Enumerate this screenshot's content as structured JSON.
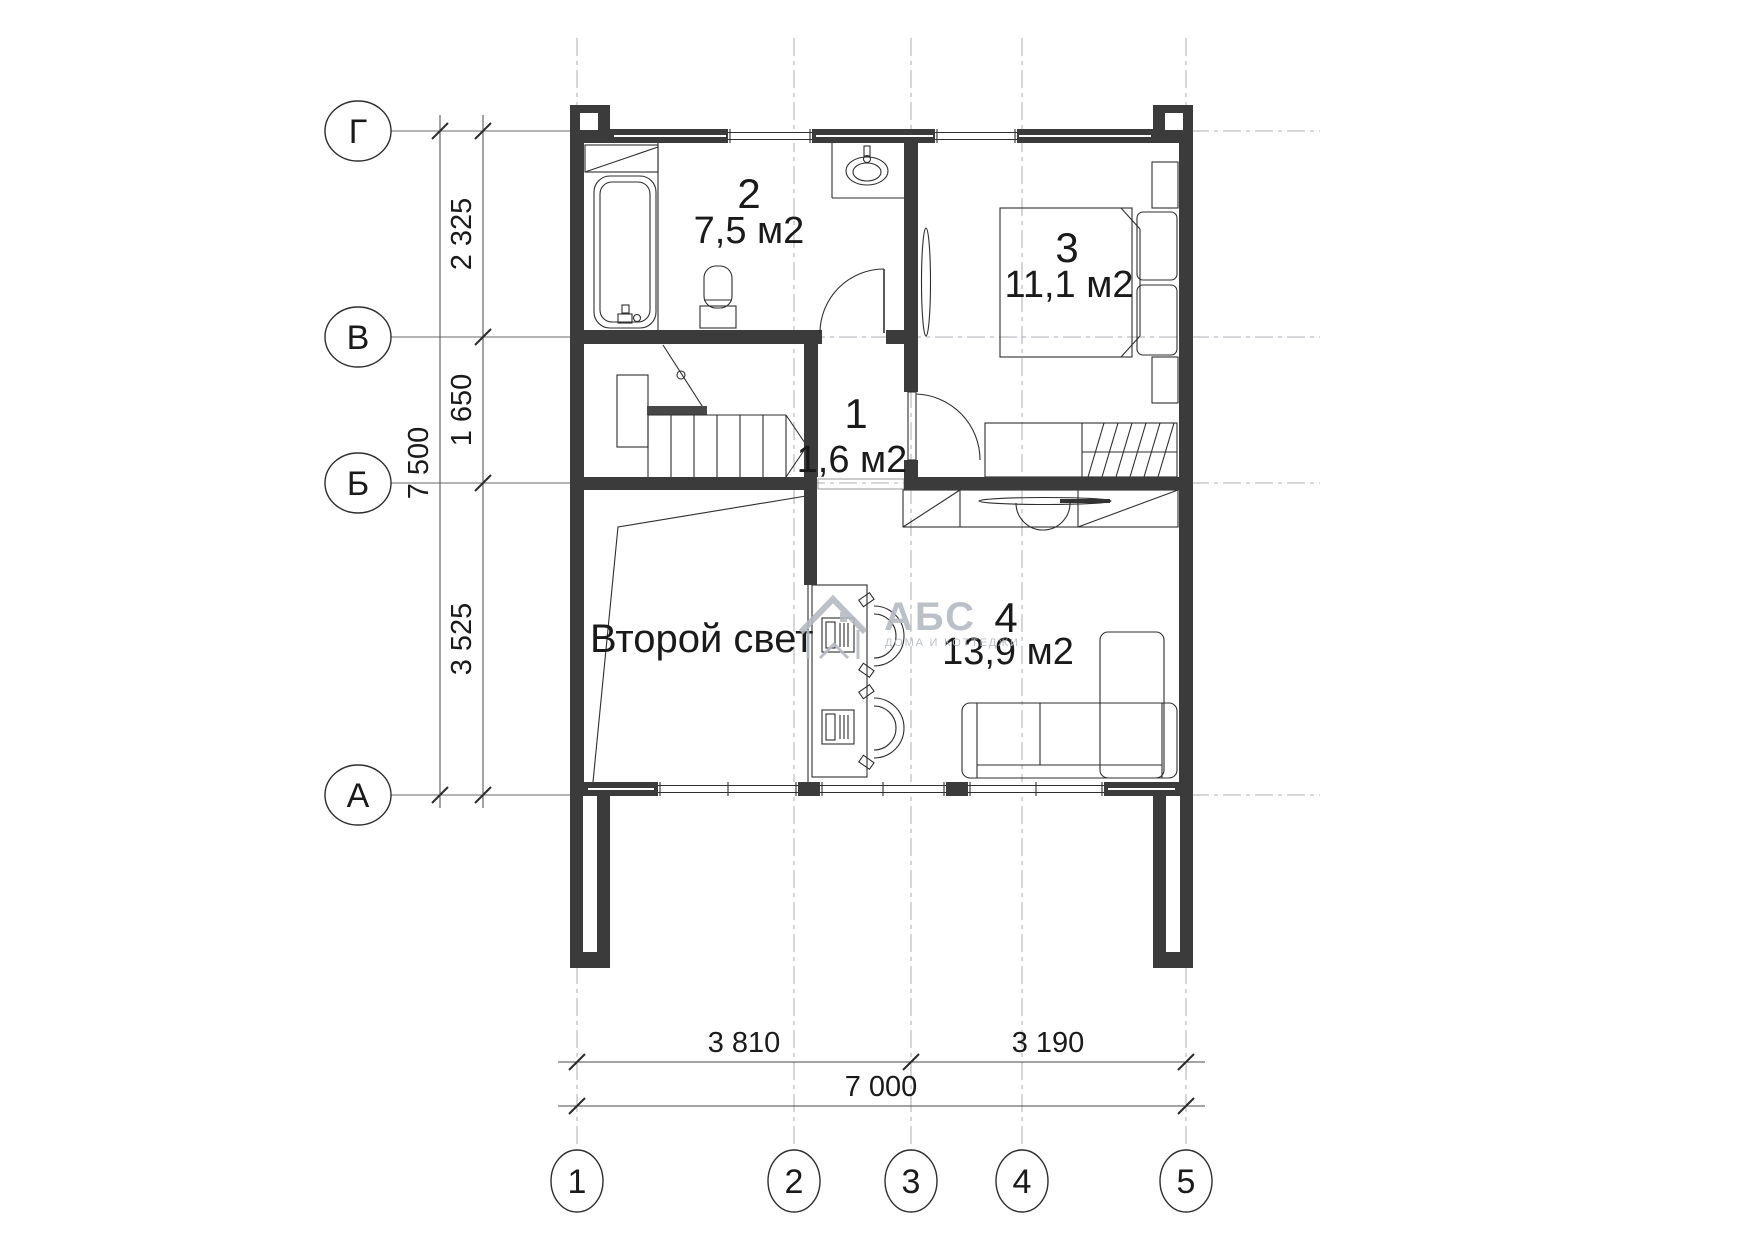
{
  "axes": {
    "horizontal": [
      "Г",
      "В",
      "Б",
      "А"
    ],
    "vertical": [
      "1",
      "2",
      "3",
      "4",
      "5"
    ]
  },
  "dimensions": {
    "left_segments": [
      "2 325",
      "1 650",
      "3 525"
    ],
    "left_total": "7 500",
    "bottom_segments": [
      "3 810",
      "3 190"
    ],
    "bottom_total": "7 000"
  },
  "rooms": {
    "bathroom": {
      "number": "2",
      "area": "7,5 м2"
    },
    "bedroom": {
      "number": "3",
      "area": "11,1 м2"
    },
    "hall": {
      "number": "1",
      "area": "1,6 м2"
    },
    "study": {
      "number": "4",
      "area": "13,9 м2"
    }
  },
  "labels": {
    "void": "Второй свет"
  },
  "watermark": {
    "title": "АБС",
    "subtitle": "ДОМА И КОТТЕДЖИ"
  },
  "colors": {
    "wall": "#3b3b3b",
    "line": "#2e2e2e",
    "grid": "#a8aeb4",
    "dimension": "#4a4a4a",
    "text": "#1a1a1a",
    "watermark": "#b5bac1",
    "background": "#ffffff"
  }
}
